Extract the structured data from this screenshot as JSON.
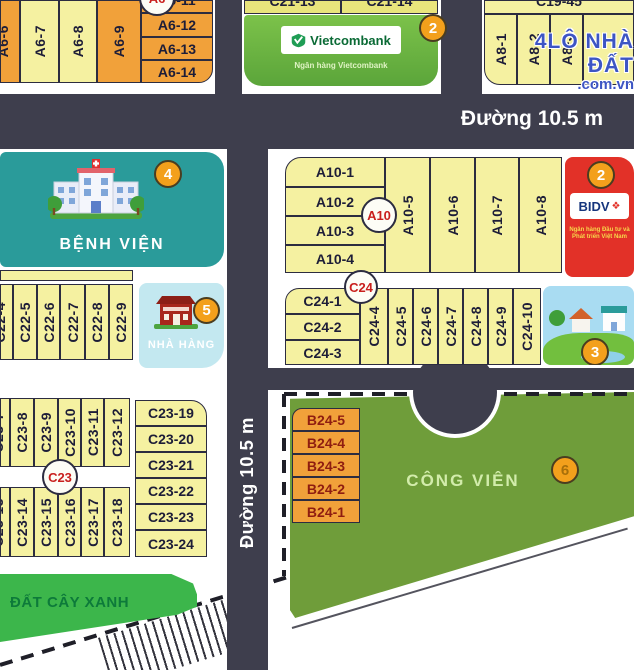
{
  "watermark": {
    "line1": "4LÔ NHÀ ĐẤT",
    "line2": ".com.vn"
  },
  "roads": {
    "top_label": "Đường 10.5 m",
    "mid_label": "Đường 10.5 m"
  },
  "blocks": {
    "a6": {
      "circle": "A6",
      "cols": [
        "A6-6",
        "A6-7",
        "A6-8",
        "A6-9"
      ],
      "rows": [
        "A6-11",
        "A6-12",
        "A6-13",
        "A6-14"
      ]
    },
    "c21": {
      "rows": [
        "C21-13",
        "C21-14"
      ]
    },
    "vietcombank": {
      "badge": "2",
      "name": "Vietcombank",
      "subtitle": "Ngân hàng Vietcombank"
    },
    "a8": {
      "top_partial": "C19-45",
      "cols": [
        "A8-1",
        "A8-2",
        "A8-3"
      ]
    },
    "hospital": {
      "badge": "4",
      "label": "BỆNH VIỆN"
    },
    "a10": {
      "circle": "A10",
      "rows": [
        "A10-1",
        "A10-2",
        "A10-3",
        "A10-4"
      ],
      "cols": [
        "A10-5",
        "A10-6",
        "A10-7",
        "A10-8"
      ]
    },
    "bidv": {
      "badge": "2",
      "name": "BIDV",
      "logo_glyph": "❖",
      "subtitle": "Ngân hàng Đầu tư và Phát triển Việt Nam"
    },
    "c22": {
      "cols": [
        "C22-4",
        "C22-5",
        "C22-6",
        "C22-7",
        "C22-8",
        "C22-9"
      ]
    },
    "restaurant": {
      "badge": "5",
      "label": "NHÀ HÀNG"
    },
    "c24": {
      "circle": "C24",
      "rows": [
        "C24-1",
        "C24-2",
        "C24-3"
      ],
      "cols": [
        "C24-4",
        "C24-5",
        "C24-6",
        "C24-7",
        "C24-8",
        "C24-9",
        "C24-10"
      ]
    },
    "scene": {
      "badge": "3"
    },
    "c23": {
      "circle": "C23",
      "top_cols": [
        "C23-7",
        "C23-8",
        "C23-9",
        "C23-10",
        "C23-11",
        "C23-12"
      ],
      "bottom_cols": [
        "C23-13",
        "C23-14",
        "C23-15",
        "C23-16",
        "C23-17",
        "C23-18"
      ],
      "rows": [
        "C23-19",
        "C23-20",
        "C23-21",
        "C23-22",
        "C23-23",
        "C23-24"
      ]
    },
    "b24": {
      "rows": [
        "B24-5",
        "B24-4",
        "B24-3",
        "B24-2",
        "B24-1"
      ]
    },
    "park": {
      "badge": "6",
      "label": "CÔNG VIÊN"
    },
    "green_strip": {
      "label": "ĐẤT CÂY XANH"
    }
  },
  "colors": {
    "road": "#3e3e4d",
    "plot_pale_yellow": "#f5f1a1",
    "plot_orange": "#f1a13a",
    "b24_text": "#8f1d10",
    "hospital_teal": "#2a9b9a",
    "restaurant_blue": "#c3e8f0",
    "vietcombank_green": "#68b63e",
    "bidv_red": "#e23128",
    "park_green": "#6f9d3a",
    "green_strip": "#3cb64b",
    "badge_orange": "#f3a01c",
    "circle_red_text": "#c9201d",
    "watermark_blue": "#3d55c4"
  }
}
